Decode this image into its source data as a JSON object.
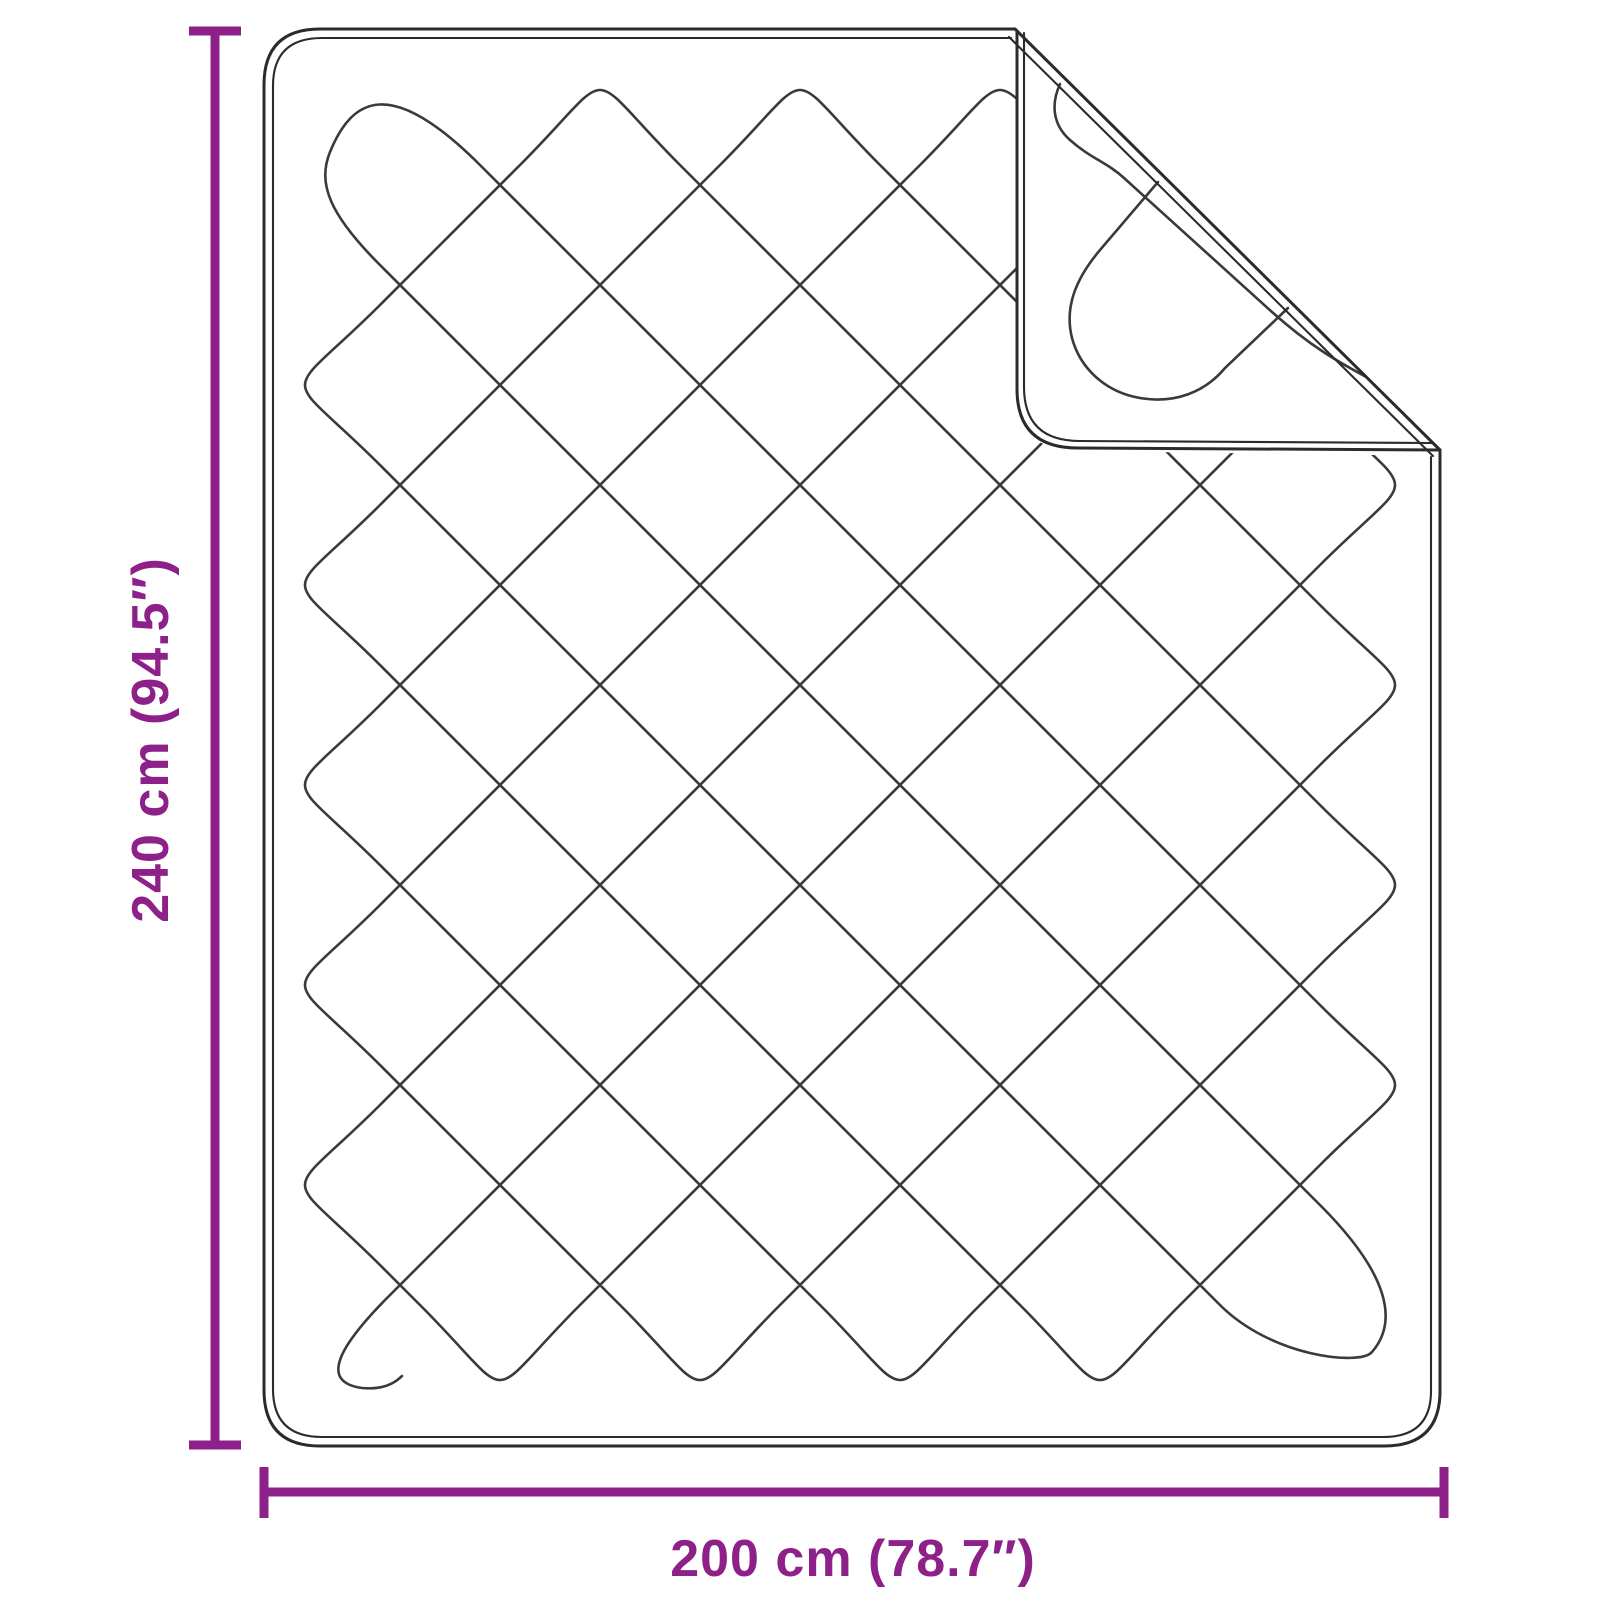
{
  "diagram": {
    "title": "quilted-blanket-dimension-diagram",
    "product": "quilted blanket with folded corner",
    "height_label": "240 cm (94.5″)",
    "width_label": "200 cm (78.7″)",
    "accent_color": "#8e2089",
    "stitch_line_color": "#3a3a3a",
    "outline_color": "#2b2b2b",
    "background_color": "#ffffff"
  }
}
